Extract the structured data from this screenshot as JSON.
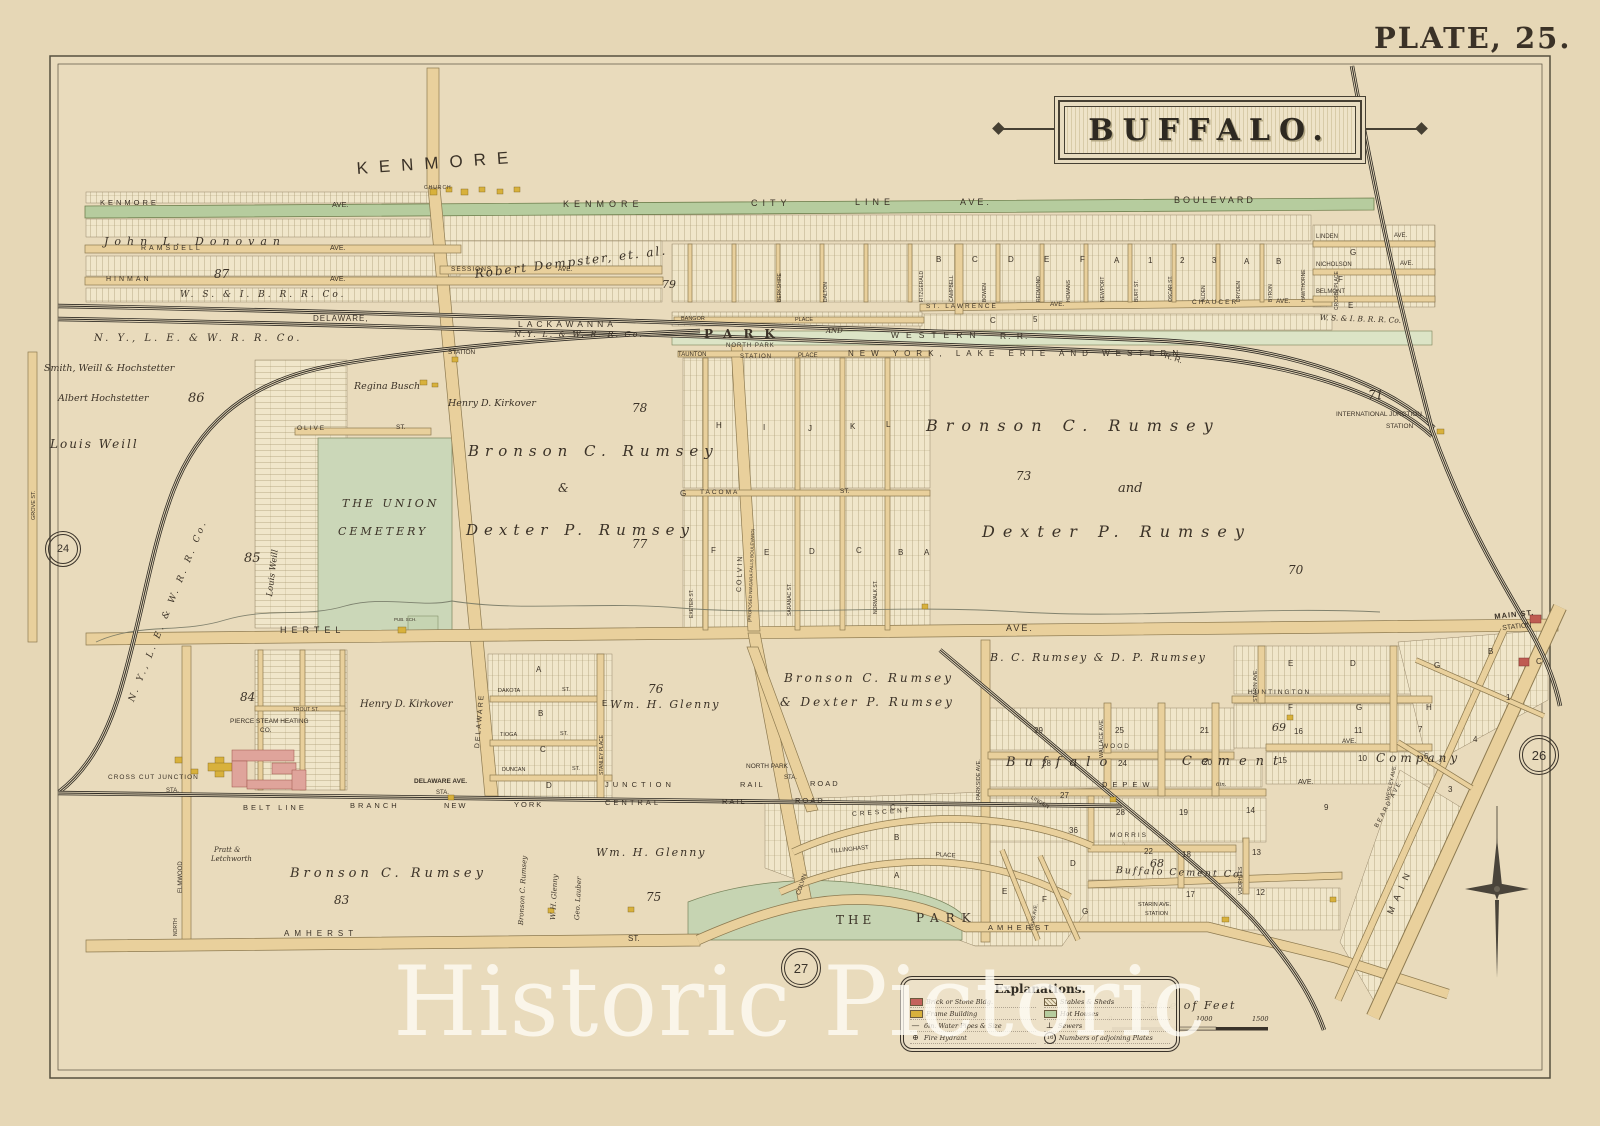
{
  "page": {
    "plate_title": "PLATE, 25.",
    "city_banner": "BUFFALO.",
    "watermark": "Historic Pictoric"
  },
  "adjoining_plates": {
    "west": "24",
    "east": "26",
    "south": "27",
    "legend_sample": "16"
  },
  "common": {
    "ave": "AVE.",
    "st": "ST.",
    "sta": "STA.",
    "station": "STATION",
    "place": "PLACE",
    "and": "AND",
    "church": "CHURCH",
    "pub_sch": "PUB. SCH.",
    "six_in": "6in."
  },
  "streets": {
    "kenmore_display": "KENMORE",
    "kenmore": "KENMORE",
    "city": "CITY",
    "line": "LINE",
    "boulevard": "BOULEVARD",
    "ramsdell": "RAMSDELL",
    "hinman": "HINMAN",
    "sessions": "SESSIONS",
    "st_lawrence": "ST. LAWRENCE",
    "chaucer": "CHAUCER",
    "linden": "LINDEN",
    "nicholson": "NICHOLSON",
    "belmont": "BELMONT",
    "olive": "OLIVE",
    "taunton": "TAUNTON",
    "bangor": "BANGOR",
    "tacoma": "TACOMA",
    "hertel": "HERTEL",
    "delaware": "DELAWARE",
    "grove": "GROVE ST.",
    "north": "NORTH",
    "elmwood": "ELMWOOD",
    "colvin": "COLVIN",
    "colvin_note": "(PROPOSED NIAGARA FALLS BOULEVARD)",
    "dakota": "DAKOTA",
    "tioga": "TIOGA",
    "duncan": "DUNCAN",
    "stanley_place": "STANLEY PLACE",
    "trout": "TROUT ST.",
    "amherst": "AMHERST",
    "main": "MAIN",
    "parkside": "PARKSIDE AVE.",
    "wallace": "WALLACE AVE.",
    "wood": "WOOD",
    "depew": "DEPEW",
    "morris": "MORRIS",
    "huntington": "HUNTINGTON",
    "starin": "STARIN AVE.",
    "wesley": "WESLEY AVE.",
    "voorhees": "VOORHEES",
    "beard": "BEARD AVE.",
    "crescent": "CRESCENT",
    "tillinghast": "TILLINGHAST",
    "davis": "DAVIS AVE.",
    "vertical_band": [
      "BERKSHIRE",
      "DALTON",
      "FITZGERALD",
      "CAMPBELL",
      "BOWEN",
      "REDMOND",
      "HOMANS",
      "NEWPORT",
      "BURT ST.",
      "OSCAR ST.",
      "ALDEN",
      "DRYDEN",
      "BYRON",
      "HAWTHORNE",
      "CROSBY PLACE"
    ],
    "grid_verticals": [
      "EXETER ST.",
      "SARANAC ST.",
      "NORWALK ST."
    ]
  },
  "railroads": {
    "wsibrr": "W. S. & I. B. R. R. Co.",
    "delaware_lbl": "DELAWARE,",
    "lackawanna": "LACKAWANNA",
    "nylw": "N.Y. L. & W. R. R. Co.",
    "nylew": "N. Y., L. E. & W. R. R. Co.",
    "park": "PARK",
    "western": "WESTERN",
    "rr": "R. R.",
    "ny_lake_erie_western": "NEW YORK, LAKE ERIE AND WESTERN",
    "north_park": "NORTH PARK",
    "belt_line": "BELT LINE",
    "branch": "BRANCH",
    "new": "NEW",
    "york": "YORK",
    "central": "CENTRAL",
    "rail": "RAIL",
    "road": "ROAD",
    "junction": "JUNCTION"
  },
  "stations": {
    "north_park_sta": "NORTH PARK",
    "international1": "INTERNATIONAL JUNCTION",
    "international2": "STATION",
    "main_st1": "MAIN ST.",
    "main_st2": "STATION",
    "cross_cut": "CROSS CUT JUNCTION",
    "delaware_ave_sta": "DELAWARE AVE.",
    "starin1": "STARIN AVE.",
    "starin2": "STATION"
  },
  "properties": {
    "donovan": "John L. Donovan",
    "dempster": "Robert Dempster, et. al.",
    "smith": "Smith, Weill & Hochstetter",
    "albert": "Albert Hochstetter",
    "louis": "Louis Weill",
    "regina": "Regina Busch",
    "kirkover": "Henry D. Kirkover",
    "bronson": "Bronson C. Rumsey",
    "dexter": "Dexter P. Rumsey",
    "amp": "&",
    "and_w": "and",
    "dexter_amp": "& Dexter P. Rumsey",
    "bc_dp": "B. C. Rumsey & D. P. Rumsey",
    "glenny": "Wm. H. Glenny",
    "glenny_v": "W. H. Glenny",
    "lauber": "Geo. Lauber",
    "pratt1": "Pratt &",
    "pratt2": "Letchworth",
    "pierce1": "PIERCE STEAM HEATING",
    "pierce2": "CO.",
    "buffalo_w": "Buffalo",
    "cement_w": "Cement",
    "company_w": "Company",
    "buffalo_cement_co": "Buffalo Cement Co."
  },
  "areas": {
    "union1": "THE UNION",
    "union2": "CEMETERY",
    "park1": "THE",
    "park2": "PARK"
  },
  "sections": {
    "n86": "86",
    "n87": "87",
    "n85": "85",
    "n84": "84",
    "n83": "83",
    "n79": "79",
    "n78": "78",
    "n77": "77",
    "n76": "76",
    "n75": "75",
    "n73": "73",
    "n71": "71",
    "n70": "70",
    "n69": "69",
    "n68": "68"
  },
  "lot_numbers": {
    "n1": "1",
    "n2": "2",
    "n3": "3",
    "n4": "4",
    "n5": "5",
    "n6": "6",
    "n7": "7",
    "n9": "9",
    "n10": "10",
    "n11": "11",
    "n12": "12",
    "n13": "13",
    "n14": "14",
    "n15": "15",
    "n16": "16",
    "n17": "17",
    "n18": "18",
    "n19": "19",
    "n20": "20",
    "n21": "21",
    "n22": "22",
    "n24": "24",
    "n25": "25",
    "n27": "27",
    "n28": "28",
    "n29": "29",
    "n36": "36"
  },
  "block_letters": {
    "a": "A",
    "b": "B",
    "c": "C",
    "d": "D",
    "e": "E",
    "f": "F",
    "g": "G",
    "h": "H",
    "i": "I",
    "j": "J",
    "k": "K",
    "l": "L"
  },
  "legend": {
    "title": "Explanations.",
    "brick": "Brick or Stone Bldg.",
    "frame": "Frame Building",
    "water": "6in. Water Pipes & Size",
    "hydrant": "Fire Hydrant",
    "hydrant_icon": "⊕",
    "stables": "Stables & Sheds",
    "hot": "Hot Houses",
    "sewers": "Sewers",
    "sewer_icon": "⊥",
    "plates": "Numbers of adjoining Plates"
  },
  "scale": {
    "title": "Scale of Feet",
    "t0": "0",
    "t500": "500",
    "t1000": "1000",
    "t1500": "1500"
  }
}
